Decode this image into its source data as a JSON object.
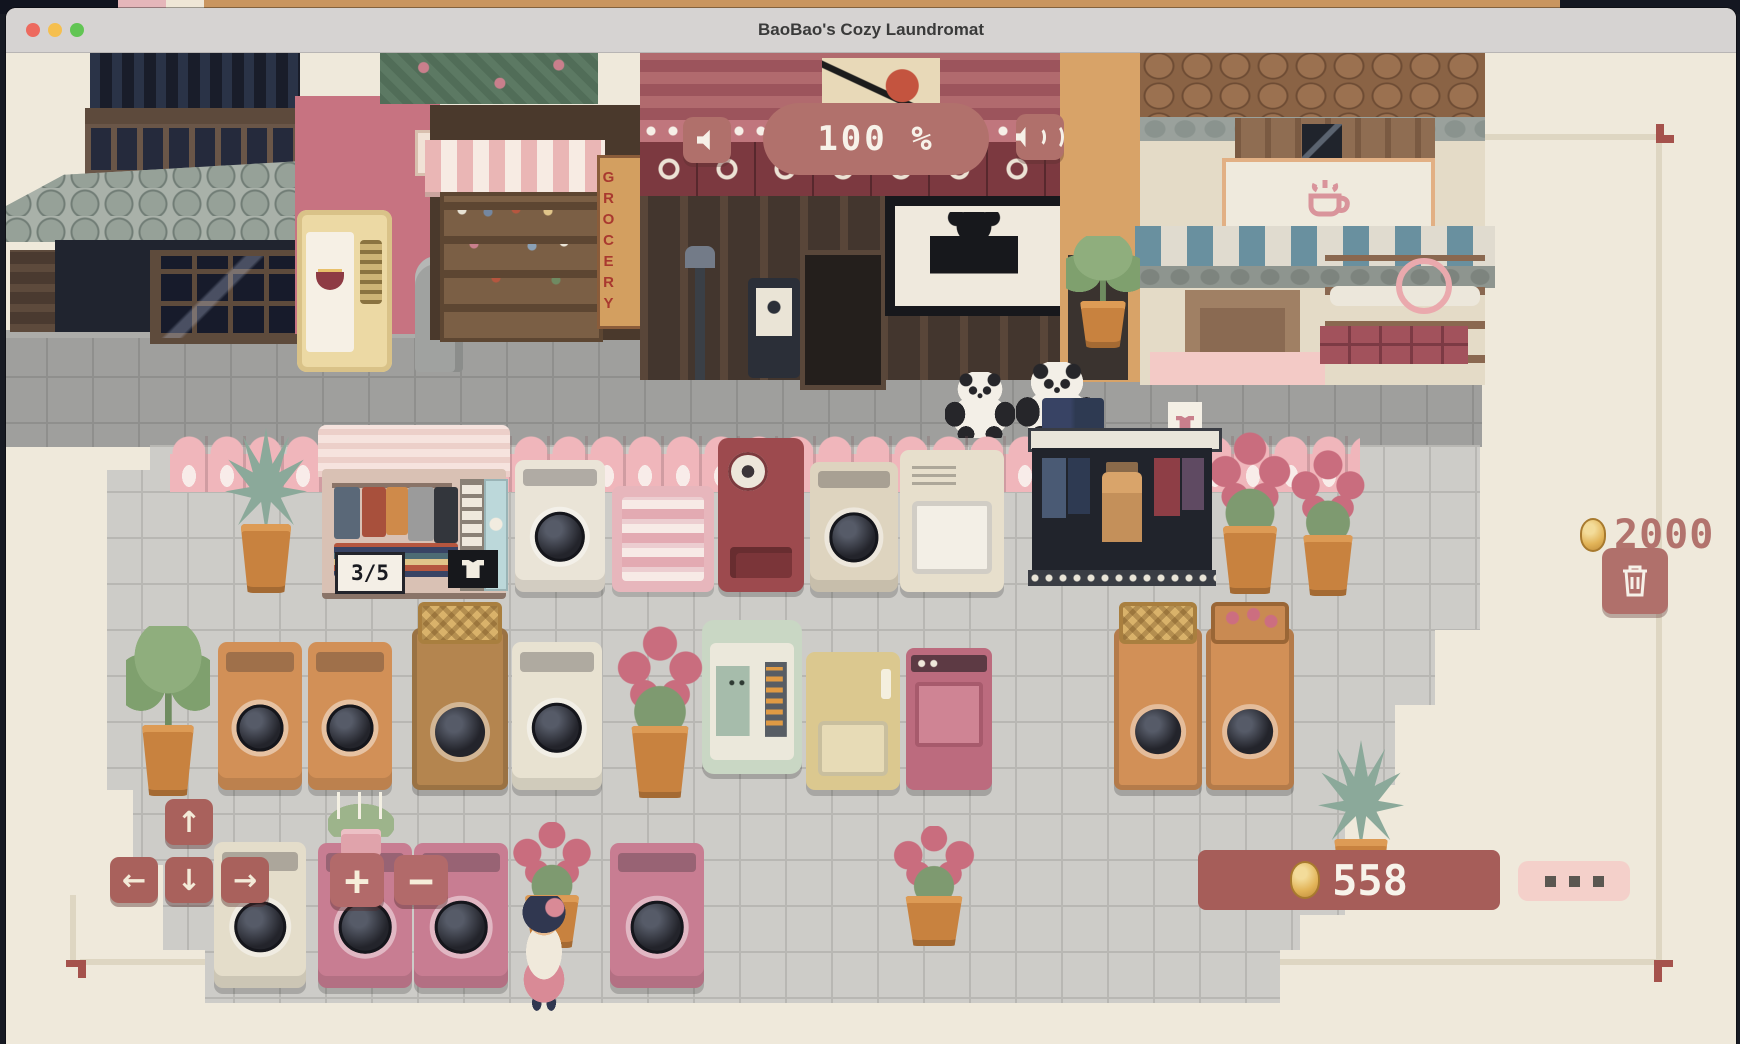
{
  "window": {
    "title": "BaoBao's Cozy Laundromat"
  },
  "titlebar": {
    "close_color": "#ed6a5f",
    "minimize_color": "#f5bf4f",
    "zoom_color": "#62c554"
  },
  "hud": {
    "durability_pill": {
      "text": "100 %"
    },
    "sfx_button": {
      "icon": "speaker-icon"
    },
    "music_button": {
      "icon": "speaker-waves-icon"
    },
    "price_tag": {
      "amount": "2000",
      "icon": "coin-icon",
      "text_color": "#b2736d"
    },
    "trash_button": {
      "icon": "trash-icon"
    },
    "wallet": {
      "amount": "558",
      "icon": "coin-icon",
      "bar_color": "#a65d59"
    },
    "more_button": {
      "icon": "ellipsis-icon"
    },
    "dpad": {
      "up": "↑",
      "left": "←",
      "down": "↓",
      "right": "→"
    },
    "plus_button": {
      "label": "+"
    },
    "minus_button": {
      "label": "−"
    },
    "accent_color": "#b0706b"
  },
  "shops": {
    "rack_capacity": "3/5",
    "grocery_sign": "GROCERY",
    "rack_shirt_icon": "shirt-icon",
    "cafe_sign_icon": "coffee-cup-icon"
  },
  "scene": {
    "entities": [
      {
        "type": "pot-agave",
        "x": 225,
        "y": 428,
        "w": 82,
        "h": 165,
        "i": true
      },
      {
        "type": "washer",
        "x": 515,
        "y": 460,
        "w": 90,
        "h": 132,
        "c": "#eae4d7",
        "i": true
      },
      {
        "type": "towels",
        "x": 612,
        "y": 486,
        "w": 102,
        "h": 106,
        "i": true
      },
      {
        "type": "vend-maroon",
        "x": 718,
        "y": 438,
        "w": 86,
        "h": 154,
        "i": true
      },
      {
        "type": "washer",
        "x": 810,
        "y": 462,
        "w": 88,
        "h": 130,
        "c": "#ded4bf",
        "i": true
      },
      {
        "type": "dryer",
        "x": 900,
        "y": 450,
        "w": 104,
        "h": 142,
        "c": "#e7dfcc",
        "i": true
      },
      {
        "type": "pot-flower",
        "x": 1206,
        "y": 432,
        "w": 88,
        "h": 162,
        "i": true
      },
      {
        "type": "pot-flower",
        "x": 1288,
        "y": 450,
        "w": 80,
        "h": 146,
        "i": true
      },
      {
        "type": "pot-palm",
        "x": 126,
        "y": 626,
        "w": 84,
        "h": 170,
        "i": true
      },
      {
        "type": "washer",
        "x": 218,
        "y": 642,
        "w": 84,
        "h": 148,
        "c": "#d29057",
        "i": true
      },
      {
        "type": "washer",
        "x": 308,
        "y": 642,
        "w": 84,
        "h": 148,
        "c": "#d29057",
        "i": true
      },
      {
        "type": "crate",
        "x": 412,
        "y": 628,
        "w": 96,
        "h": 162,
        "c": "#b4854f",
        "i": true
      },
      {
        "type": "washer",
        "x": 512,
        "y": 642,
        "w": 90,
        "h": 148,
        "c": "#e8e2d1",
        "i": true
      },
      {
        "type": "pot-flower",
        "x": 614,
        "y": 626,
        "w": 92,
        "h": 172,
        "i": true
      },
      {
        "type": "vend-mint",
        "x": 702,
        "y": 620,
        "w": 100,
        "h": 154,
        "i": true
      },
      {
        "type": "locker",
        "x": 806,
        "y": 652,
        "w": 94,
        "h": 138,
        "c": "#dbc88f",
        "i": true
      },
      {
        "type": "pinkmach",
        "x": 906,
        "y": 648,
        "w": 86,
        "h": 142,
        "i": true
      },
      {
        "type": "crate",
        "x": 1114,
        "y": 628,
        "w": 88,
        "h": 162,
        "c": "#d29057",
        "i": true
      },
      {
        "type": "crateflower",
        "x": 1206,
        "y": 628,
        "w": 88,
        "h": 162,
        "c": "#d29057",
        "i": true
      },
      {
        "type": "pot-agave",
        "x": 1318,
        "y": 740,
        "w": 86,
        "h": 170,
        "i": true
      },
      {
        "type": "washer",
        "x": 214,
        "y": 842,
        "w": 92,
        "h": 146,
        "c": "#e4ddca",
        "i": true
      },
      {
        "type": "washer",
        "x": 318,
        "y": 843,
        "w": 94,
        "h": 145,
        "c": "#c87d92",
        "i": true
      },
      {
        "type": "washer",
        "x": 414,
        "y": 843,
        "w": 94,
        "h": 145,
        "c": "#c87d92",
        "i": true
      },
      {
        "type": "washer",
        "x": 610,
        "y": 843,
        "w": 94,
        "h": 145,
        "c": "#c87d92",
        "i": true
      },
      {
        "type": "pot-candle",
        "x": 328,
        "y": 792,
        "w": 66,
        "h": 64,
        "z": 1200,
        "i": true
      },
      {
        "type": "pot-flower",
        "x": 508,
        "y": 822,
        "w": 88,
        "h": 126,
        "i": true
      },
      {
        "type": "pot-flower",
        "x": 888,
        "y": 826,
        "w": 92,
        "h": 120,
        "i": true
      },
      {
        "type": "pot-palm",
        "x": 1066,
        "y": 236,
        "w": 74,
        "h": 112,
        "i": false
      },
      {
        "type": "panda",
        "x": 945,
        "y": 372,
        "w": 70,
        "h": 66,
        "i": false
      },
      {
        "type": "panda",
        "x": 1016,
        "y": 362,
        "w": 82,
        "h": 78,
        "i": false
      },
      {
        "type": "girl",
        "x": 514,
        "y": 896,
        "w": 60,
        "h": 116,
        "z": 1300,
        "i": false
      }
    ]
  }
}
